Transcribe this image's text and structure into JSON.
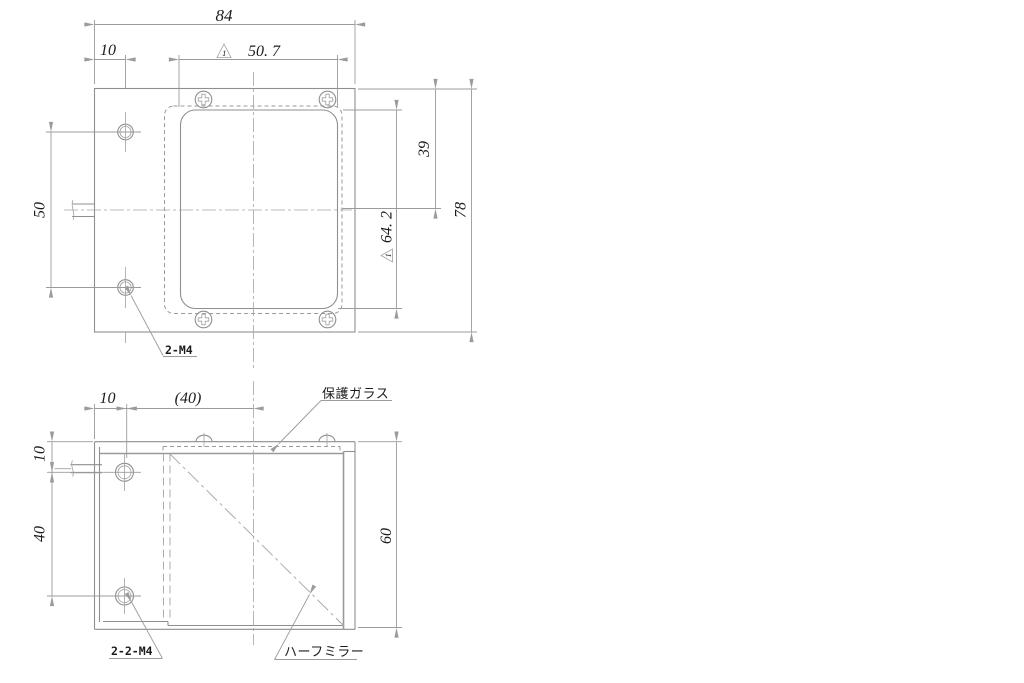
{
  "drawing": {
    "colors": {
      "object_line": "#8f8f8f",
      "dimension_line": "#9b9b9b",
      "text": "#1c1c1c",
      "background": "#ffffff"
    },
    "top_view": {
      "width_dim": "84",
      "hole_offset_dim": "10",
      "aperture_width_dim": "50. 7",
      "aperture_width_finish_mark": "1",
      "edge_to_center_dim": "39",
      "aperture_height_dim": "64. 2",
      "aperture_height_finish_mark": "1",
      "height_dim": "78",
      "hole_pitch_dim": "50",
      "thread_label": "2-M4"
    },
    "side_view": {
      "hole_offset_dim": "10",
      "ref_width_dim": "(40)",
      "top_offset_dim": "10",
      "hole_pitch_dim": "40",
      "height_dim": "60",
      "thread_label": "2-2-M4",
      "glass_label": "保護ガラス",
      "mirror_label": "ハーフミラー"
    }
  }
}
